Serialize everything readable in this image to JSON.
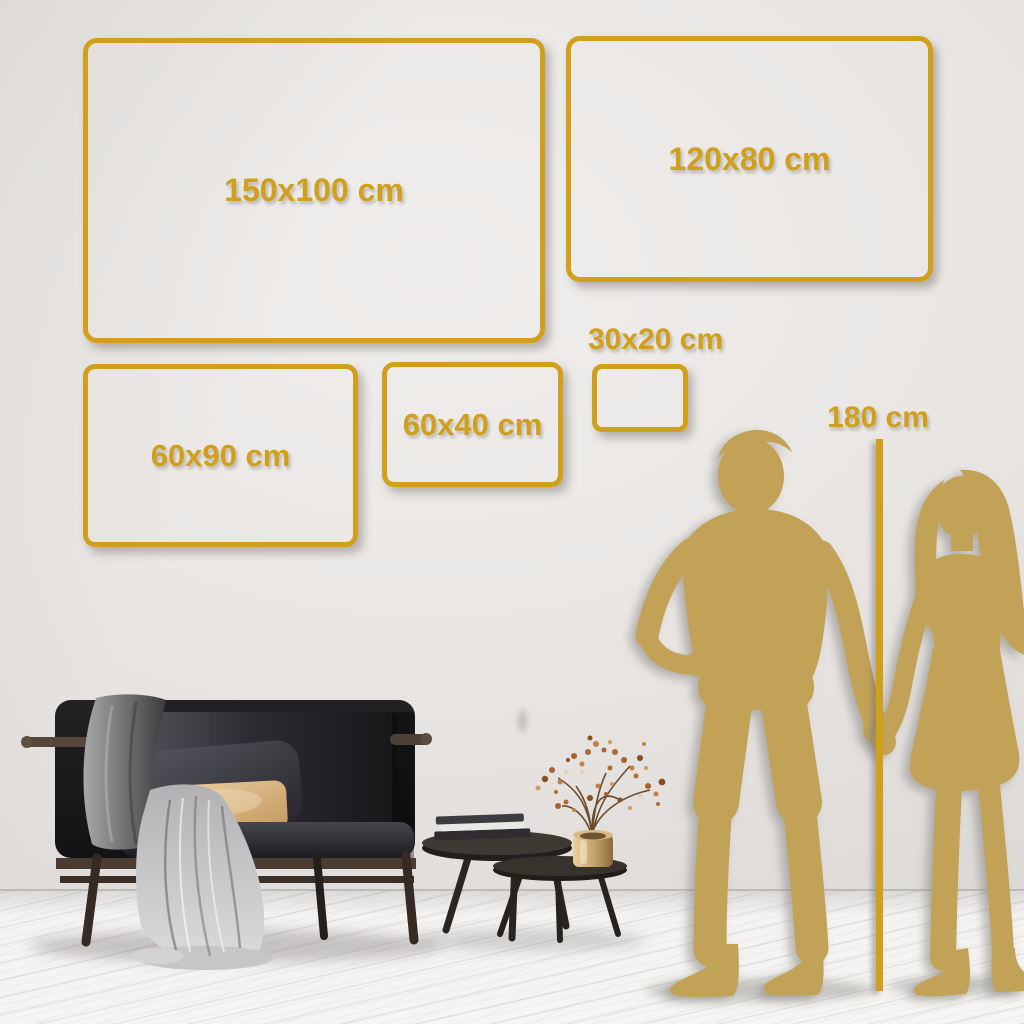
{
  "colors": {
    "gold": "#d0a01c",
    "silhouette_gold": "#c1a256"
  },
  "frames": [
    {
      "label": "150x100 cm",
      "width_cm": 150,
      "height_cm": 100
    },
    {
      "label": "120x80 cm",
      "width_cm": 120,
      "height_cm": 80
    },
    {
      "label": "60x90 cm",
      "width_cm": 60,
      "height_cm": 90
    },
    {
      "label": "60x40 cm",
      "width_cm": 60,
      "height_cm": 40
    },
    {
      "label": "30x20 cm",
      "width_cm": 30,
      "height_cm": 20
    }
  ],
  "height_marker": {
    "label": "180 cm",
    "height_cm": 180
  },
  "scene": {
    "couple_icon": "man-and-woman-holding-hands-silhouette",
    "furniture_icons": [
      "sofa-with-blanket-and-pillows",
      "nesting-coffee-tables",
      "books-stack",
      "brass-vase-with-dried-branches"
    ]
  }
}
